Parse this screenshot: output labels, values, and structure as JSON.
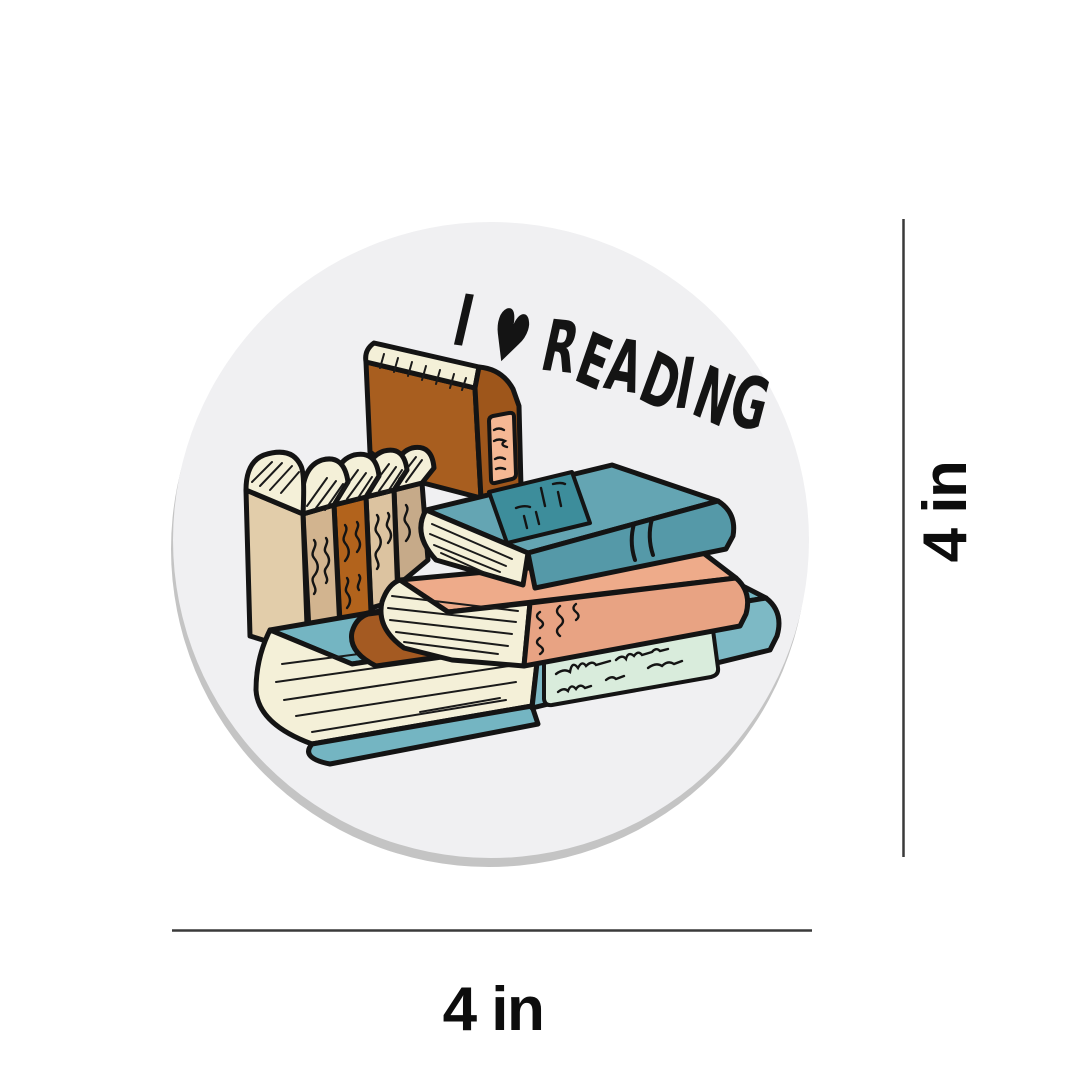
{
  "product_mockup": {
    "page_background": "#ffffff",
    "sticker": {
      "shape": "circle",
      "base_color": "#f0f0f2",
      "shadow_color": "#c4c4c4",
      "lettering": {
        "text": "I ♥ READING",
        "color": "#141414"
      },
      "illustration": {
        "subject": "hand-drawn stack of books",
        "colors": {
          "outline": "#141414",
          "pages_cream": "#f4f0d8",
          "top_teal_book": "#64a5b3",
          "top_teal_label": "#3d8d9b",
          "bottom_teal_book": "#74b5c2",
          "mint_spine_label": "#d9ecdc",
          "salmon_book": "#eeab8a",
          "brown_book_cover": "#a85e1f",
          "brown_book_spine": "#9e561b",
          "brown_spine_label": "#f5b894",
          "beige_cover": "#e2cdaa",
          "tan_spine": "#d2b48f",
          "orange_spine": "#b2631c",
          "light_tan_spine": "#dcc3a0",
          "dark_tan_spine": "#c6aa89",
          "sienna_thin_book": "#a45a22"
        }
      }
    },
    "dimensions": {
      "width_label": "4 in",
      "height_label": "4 in",
      "line_color": "#3a3a3a",
      "label_color": "#0d0d0d"
    }
  }
}
